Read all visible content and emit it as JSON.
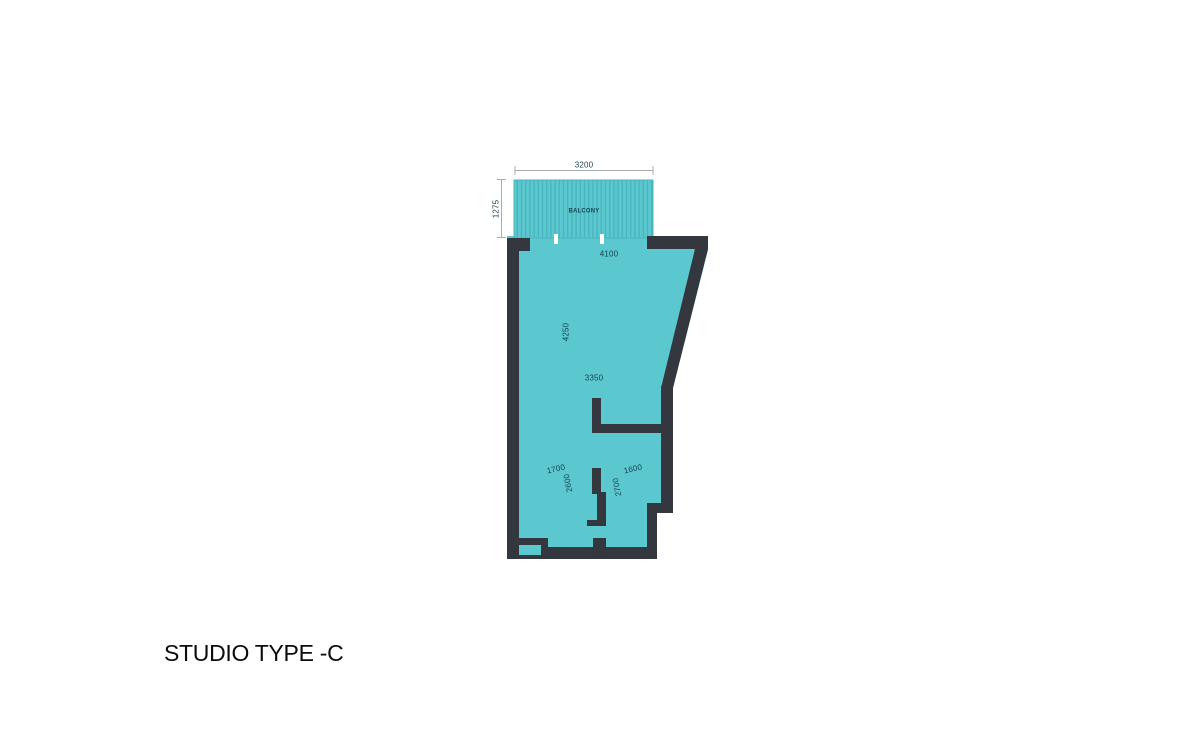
{
  "title": {
    "text": "STUDIO TYPE -C"
  },
  "floorplan": {
    "balcony": {
      "label": "BALCONY",
      "width": "3200",
      "depth": "1275"
    },
    "living": {
      "width": "4100",
      "length": "4250",
      "inner_width": "3350"
    },
    "bath": {
      "width": "1700",
      "depth": "2600"
    },
    "bedroom": {
      "width": "1600",
      "depth": "2700"
    },
    "colors": {
      "floor": "#5bc8cf",
      "wall": "#34383e",
      "balcony_stripe": "#49b5be",
      "dim_text": "#173f4b",
      "dim_line": "#a7acb1",
      "title_text": "#0b0b0b",
      "page_bg": "#ffffff"
    }
  }
}
